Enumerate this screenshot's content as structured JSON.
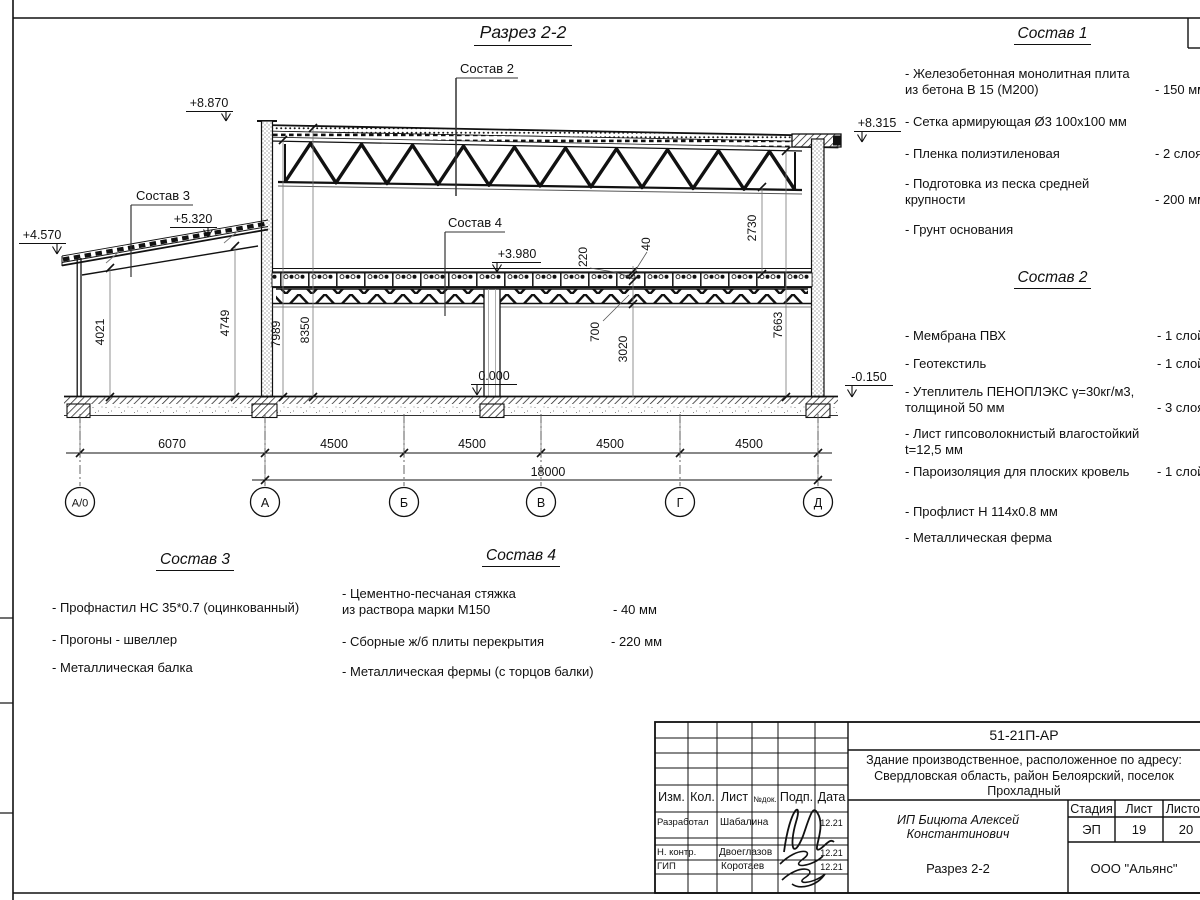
{
  "drawing": {
    "title": "Разрез 2-2",
    "leaders": {
      "sostav2": "Состав 2",
      "sostav3": "Состав 3",
      "sostav4": "Состав 4"
    },
    "elevations": {
      "roof_left": "+8.870",
      "roof_right": "+8.315",
      "annex_high": "+5.320",
      "annex_low": "+4.570",
      "mezzanine": "+3.980",
      "floor": "0.000",
      "ground": "-0.150"
    },
    "vdims": {
      "annex_left": "4021",
      "annex_right": "4749",
      "main_left_inner": "7989",
      "main_left_outer": "8350",
      "roof_clear": "2730",
      "main_right": "7663",
      "screed": "40",
      "slab": "220",
      "truss": "700",
      "ground_floor": "3020"
    },
    "hdims": {
      "spans": [
        "6070",
        "4500",
        "4500",
        "4500",
        "4500"
      ],
      "total": "18000"
    },
    "axes": [
      "А/0",
      "А",
      "Б",
      "В",
      "Г",
      "Д"
    ]
  },
  "lists": [
    {
      "title": "Состав 1",
      "items": [
        {
          "text": "- Железобетонная  монолитная плита\n  из бетона В 15 (М200)",
          "value": "- 150 мм"
        },
        {
          "text": "- Сетка армирующая Ø3 100х100 мм",
          "value": ""
        },
        {
          "text": "- Пленка полиэтиленовая",
          "value": "-  2 слоя"
        },
        {
          "text": "- Подготовка из песка средней\n  крупности",
          "value": "- 200 мм"
        },
        {
          "text": "- Грунт основания",
          "value": ""
        }
      ]
    },
    {
      "title": "Состав 2",
      "items": [
        {
          "text": "- Мембрана ПВХ",
          "value": "- 1 слой"
        },
        {
          "text": "- Геотекстиль",
          "value": "- 1 слой"
        },
        {
          "text": "- Утеплитель ПЕНОПЛЭКС γ=30кг/м3,\n  толщиной 50 мм",
          "value": "- 3 слоя"
        },
        {
          "text": "- Лист гипсоволокнистый влагостойкий\n t=12,5 мм",
          "value": ""
        },
        {
          "text": "- Пароизоляция для плоских кровель",
          "value": "- 1 слой"
        },
        {
          "text": "- Профлист Н 114х0.8 мм",
          "value": ""
        },
        {
          "text": "- Металлическая ферма",
          "value": ""
        }
      ]
    },
    {
      "title": "Состав 3",
      "items": [
        {
          "text": "- Профнастил НС 35*0.7 (оцинкованный)",
          "value": ""
        },
        {
          "text": "- Прогоны - швеллер",
          "value": ""
        },
        {
          "text": "- Металлическая балка",
          "value": ""
        }
      ]
    },
    {
      "title": "Состав 4",
      "items": [
        {
          "text": "- Цементно-песчаная стяжка\n  из раствора марки М150",
          "value": "- 40 мм"
        },
        {
          "text": "- Сборные ж/б плиты перекрытия",
          "value": "- 220 мм"
        },
        {
          "text": "- Металлическая фермы (с торцов балки)",
          "value": ""
        }
      ]
    }
  ],
  "titleblock": {
    "doc_number": "51-21П-АР",
    "project": "Здание производственное, расположенное по адресу: Свердловская область, район Белоярский, поселок Прохладный",
    "header": {
      "izm": "Изм.",
      "kol": "Кол.",
      "list": "Лист",
      "ndoc": "№док.",
      "podp": "Подп.",
      "data": "Дата"
    },
    "rows": [
      {
        "role": "Разработал",
        "name": "Шабалина",
        "date": "12.21"
      },
      {
        "role": "Н. контр.",
        "name": "Двоеглазов",
        "date": "12.21"
      },
      {
        "role": "ГИП",
        "name": "Коротаев",
        "date": "12.21"
      }
    ],
    "client": "ИП Бицюта Алексей Константинович",
    "stage_label": "Стадия",
    "sheet_label": "Лист",
    "sheets_label": "Листов",
    "stage": "ЭП",
    "sheet": "19",
    "sheets": "20",
    "sheet_title": "Разрез 2-2",
    "company": "ООО \"Альянс\""
  }
}
